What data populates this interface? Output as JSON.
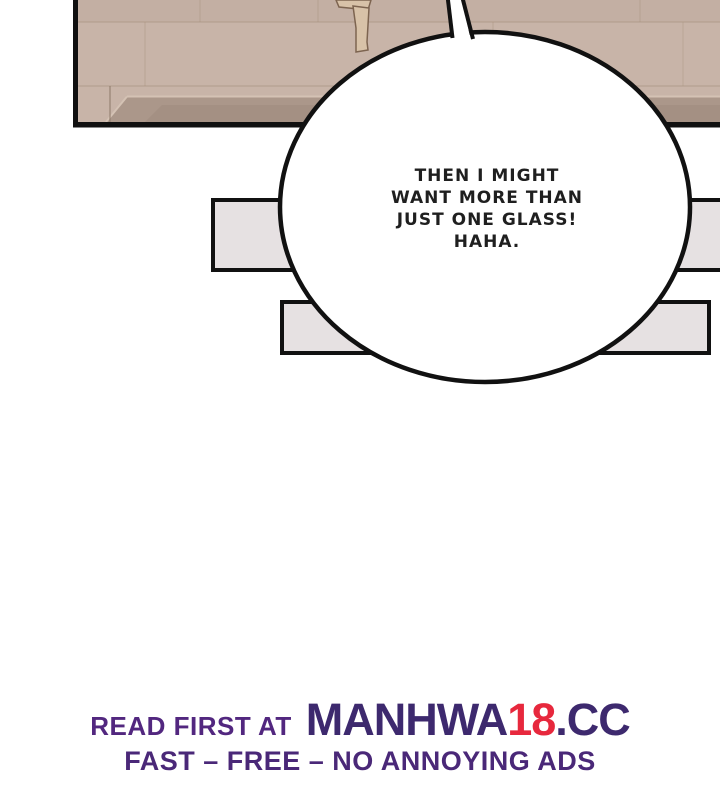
{
  "bubble": {
    "text": "THEN I MIGHT\nWANT MORE THAN\nJUST ONE GLASS!\nHAHA."
  },
  "footer": {
    "prefix": "READ FIRST AT",
    "brand": {
      "name": "MANHWA",
      "number": "18",
      "tld": ".CC"
    },
    "tagline": "FAST – FREE – NO ANNOYING ADS",
    "colors": {
      "prefix_purple": "#52277f",
      "brand_purple": "#3d296e",
      "brand_red": "#e7283d"
    }
  },
  "scene": {
    "panel": {
      "floor": "#c8b4a8",
      "floor_band_top": "#c3afa3",
      "plank_line": "#a8937f",
      "table_edge": "#ab978a",
      "table_edge_dark": "#a28e81",
      "edge_highlight": "#d4c2b4",
      "chair_wood": "#d8c2a8",
      "chair_outline": "#7d6450",
      "outline": "#101010"
    },
    "bars": {
      "fill": "#e6e1e2",
      "outline": "#111111"
    },
    "bubble": {
      "fill": "#ffffff",
      "outline": "#111111"
    }
  }
}
